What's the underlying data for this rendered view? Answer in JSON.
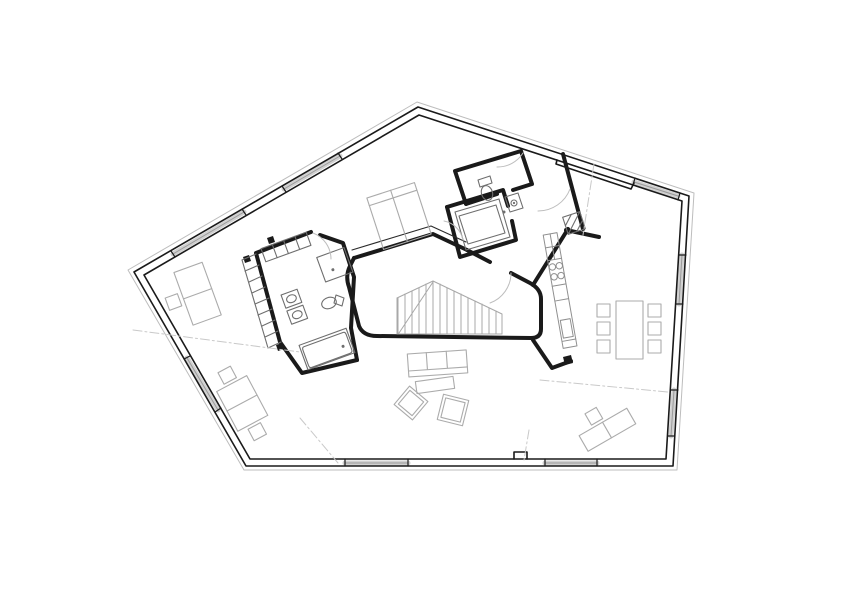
{
  "canvas": {
    "width": 842,
    "height": 595,
    "background": "#ffffff"
  },
  "palette": {
    "wall": "#1a1a1a",
    "wall_detail": "#2a2a2a",
    "fixture": "#6e6e6e",
    "counter": "#8f8f8f",
    "stair": "#a8a8a8",
    "furniture": "#ababab",
    "door": "#bdbdbd",
    "boundary": "#bdbdbd",
    "window_band": "#d0d0d0",
    "window_mid": "#9a9a9a",
    "dash": "#c9c9c9"
  },
  "layers": [
    {
      "name": "site-boundary-line",
      "stroke": "boundary",
      "width": 1,
      "shapes": [
        {
          "p": "M417,102 L694,193 L677,470 L244,470 L128,270 Z"
        }
      ]
    },
    {
      "name": "window-band",
      "stroke": "window_band",
      "width": 5,
      "shapes": [
        {
          "p": "M173,254 L244,212"
        },
        {
          "p": "M284,189 L340,156"
        },
        {
          "p": "M634,182 L678,196"
        },
        {
          "p": "M682,255 L679,304"
        },
        {
          "p": "M674,390 L671,436"
        },
        {
          "p": "M345,463 L408,463"
        },
        {
          "p": "M545,463 L597,463"
        },
        {
          "p": "M218,410 L187,358"
        }
      ]
    },
    {
      "name": "window-glass-line",
      "stroke": "window_mid",
      "width": 1,
      "shapes": [
        {
          "p": "M173,254 L244,212"
        },
        {
          "p": "M284,189 L340,156"
        },
        {
          "p": "M634,182 L678,196"
        },
        {
          "p": "M682,255 L679,304"
        },
        {
          "p": "M674,390 L671,436"
        },
        {
          "p": "M345,463 L408,463"
        },
        {
          "p": "M545,463 L597,463"
        },
        {
          "p": "M218,410 L187,358"
        }
      ]
    },
    {
      "name": "exterior-wall-outer-face",
      "stroke": "wall",
      "width": 1.6,
      "shapes": [
        {
          "p": "M418,107 L689,196 L673,466 L246,466 L134,272 Z"
        }
      ]
    },
    {
      "name": "exterior-wall-inner-face",
      "stroke": "wall",
      "width": 1.6,
      "shapes": [
        {
          "p": "M419,115 L682,201 L666,459 L250,459 L144,275 Z"
        },
        {
          "p": "M557,160 L556,164 L631,189 L634,183"
        },
        {
          "p": "M514,459 L514,452 L527,452 L527,459"
        }
      ]
    },
    {
      "name": "wall-opening-tick",
      "stroke": "wall",
      "width": 1.2,
      "shapes": [
        {
          "p": "M171,251 L175,257"
        },
        {
          "p": "M242,209 L246,215"
        },
        {
          "p": "M282,186 L286,192"
        },
        {
          "p": "M338,153 L342,159"
        },
        {
          "p": "M635,178 L633,185"
        },
        {
          "p": "M680,193 L678,200"
        },
        {
          "p": "M686,255 L679,255"
        },
        {
          "p": "M683,304 L676,304"
        },
        {
          "p": "M678,390 L671,390"
        },
        {
          "p": "M675,436 L668,436"
        },
        {
          "p": "M345,466 L345,459"
        },
        {
          "p": "M408,466 L408,459"
        },
        {
          "p": "M545,466 L545,459"
        },
        {
          "p": "M597,466 L597,459"
        },
        {
          "p": "M215,412 L221,408"
        },
        {
          "p": "M184,359 L190,356"
        }
      ]
    },
    {
      "name": "interior-wall",
      "stroke": "wall",
      "width": 4,
      "shapes": [
        {
          "p": "M354,258 L433,234 L467,250"
        },
        {
          "p": "M467,250 L490,262"
        },
        {
          "p": "M511,273 L530,283 Q541,289 541,299 L541,329 Q541,338 531,338"
        },
        {
          "p": "M531,338 L377,336 Q363,336 359,326 L349,287 Q345,276 350,266 L354,258"
        },
        {
          "p": "M533,340 L552,368 L571,361"
        },
        {
          "p": "M533,285 L568,229"
        },
        {
          "p": "M563,154 L583,229"
        },
        {
          "p": "M566,230 L599,237"
        },
        {
          "p": "M466,204 L455,171 L521,151 L532,184 L513,190"
        },
        {
          "p": "M497,194 L466,204"
        },
        {
          "p": "M447,207 L503,190 L508,206"
        },
        {
          "p": "M512,221 L516,240 L460,257 L447,207"
        },
        {
          "p": "M311,232 L256,253 L280,342 L302,373 L357,360"
        },
        {
          "p": "M357,360 L351,328 L354,277 L343,243 L320,235"
        }
      ]
    },
    {
      "name": "interior-wall-finish-line",
      "stroke": "wall_detail",
      "width": 1.1,
      "shapes": [
        {
          "p": "M352,250 L431,226 L466,242"
        }
      ]
    },
    {
      "name": "column",
      "stroke": "none",
      "fill": "wall",
      "width": 0,
      "shapes": [
        {
          "p": "M243,257 L249,255 L251,261 L245,263 Z"
        },
        {
          "p": "M267,238 L273,236 L275,242 L269,244 Z"
        },
        {
          "p": "M276,345 L282,343 L284,349 L278,351 Z"
        },
        {
          "p": "M563,357 L571,355 L573,363 L565,365 Z"
        }
      ]
    },
    {
      "name": "staircase",
      "stroke": "stair",
      "width": 1,
      "shapes": [
        {
          "p": "M397,298 L433,281 L502,314 L502,334"
        },
        {
          "p": "M397,298 L397,334"
        },
        {
          "p": "M397,334 L502,334"
        },
        {
          "p": "M398,298 L398,334 M405,294 L405,334 M412,291 L412,334 M419,288 L419,334 M426,284 L426,334 M433,281 L433,334 M440,284 L440,334 M447,288 L447,334 M454,291 L454,334 M461,294 L461,334 M468,298 L468,334 M475,301 L475,334 M482,304 L482,334 M489,308 L489,334 M496,311 L496,334"
        },
        {
          "p": "M433,282 L399,333"
        }
      ]
    },
    {
      "name": "kitchen-counter",
      "stroke": "counter",
      "width": 1,
      "shapes": [
        {
          "p": "M553,233 L567,233 L567,348 L553,348 Z",
          "tf": "rotate(-10 560 290)"
        },
        {
          "p": "M553,246 L567,246 M553,259 L567,259 M553,285 L567,285 M553,300 L567,300 M553,341 L567,341 M560,233 L560,259",
          "tf": "rotate(-10 560 290)"
        },
        {
          "p": "M555,320 L565,320 L565,338 L555,338 Z",
          "tf": "rotate(-10 560 290)"
        },
        {
          "c": [
            556.5,
            266,
            3.2
          ],
          "tf": "rotate(-10 560 290)"
        },
        {
          "c": [
            563.5,
            266,
            3.2
          ],
          "tf": "rotate(-10 560 290)"
        },
        {
          "c": [
            556.5,
            276,
            3.2
          ],
          "tf": "rotate(-10 560 290)"
        },
        {
          "c": [
            563.5,
            276,
            3.2
          ],
          "tf": "rotate(-10 560 290)"
        }
      ]
    },
    {
      "name": "bath-fixture",
      "stroke": "fixture",
      "width": 1.1,
      "shapes": [
        {
          "e": [
            487,
            193,
            5.5,
            7.5
          ],
          "tf": "rotate(-17 487 193)"
        },
        {
          "p": "M478,180 L490,176 L492,183 L480,187 Z"
        },
        {
          "p": "M505,197 L518,193 L523,208 L510,212 Z"
        },
        {
          "c": [
            514,
            203,
            3
          ]
        },
        {
          "p": "M455,212 L499,199 L510,237 L466,250 Z"
        },
        {
          "p": "M459,216 L496,205 L505,233 L468,244 Z"
        },
        {
          "p": "M286,291 L303,291 L303,305 L286,305 Z",
          "tf": "rotate(-20 295 307)"
        },
        {
          "p": "M286,308 L303,308 L303,322 L286,322 Z",
          "tf": "rotate(-20 295 307)"
        },
        {
          "e": [
            294.5,
            298,
            5,
            3.8
          ],
          "tf": "rotate(-20 295 307)"
        },
        {
          "e": [
            294.5,
            315,
            5,
            3.8
          ],
          "tf": "rotate(-20 295 307)"
        },
        {
          "e": [
            329,
            303,
            7.5,
            5.5
          ],
          "tf": "rotate(-20 329 303)"
        },
        {
          "p": "M336,295 L344,298 L342,306 L334,303 Z"
        },
        {
          "p": "M320,252 L349,252 L349,278 L320,278 Z",
          "tf": "rotate(-20 334 264)"
        },
        {
          "p": "M302,336 L352,336 L352,362 L302,362 Z",
          "tf": "rotate(-20 327 349)"
        },
        {
          "p": "M306,339 L348,339 Q350,339 350,342 L350,358 Q350,361 347,361 L306,361 Q304,361 304,358 L304,342 Q304,339 306,339 Z",
          "tf": "rotate(-20 327 349)"
        },
        {
          "p": "M565,214 L583,214 L583,232 L565,232 Z",
          "tf": "rotate(-18 574 223)"
        },
        {
          "p": "M565,232 L583,214 M565,223 L574,214 M574,232 L583,223",
          "tf": "rotate(-18 574 223)"
        },
        {
          "p": "M262,240 L310,240 L310,254 L262,254 Z",
          "tf": "rotate(-20 286 247)"
        },
        {
          "p": "M274,240 L274,254 M286,240 L286,254 M298,240 L298,254",
          "tf": "rotate(-20 286 247)"
        },
        {
          "p": "M242,260 L268,348"
        },
        {
          "p": "M242,260 L256,254 M245,271 L259,265 M249,282 L262,276 M252,293 L265,287 M255,304 L269,298 M258,315 L272,309 M262,326 L275,320 M265,337 L278,331 M268,348 L281,342"
        }
      ]
    },
    {
      "name": "fixture-drain-dot",
      "stroke": "none",
      "fill": "fixture",
      "width": 0,
      "shapes": [
        {
          "c": [
            504,
            212,
            1.5
          ]
        },
        {
          "c": [
            331,
            269,
            1.5
          ],
          "tf": "rotate(-20 334 264)"
        },
        {
          "c": [
            343,
            352,
            1.5
          ],
          "tf": "rotate(-20 327 349)"
        },
        {
          "c": [
            514,
            203,
            1.1
          ]
        }
      ]
    },
    {
      "name": "furniture",
      "stroke": "furniture",
      "width": 1.1,
      "shapes": [
        {
          "p": "M374,189 L424,189 L424,243 L374,243 Z",
          "tf": "rotate(-18 399 216)"
        },
        {
          "p": "M399,189 L399,243 M374,197 L424,197",
          "tf": "rotate(-18 399 216)"
        },
        {
          "p": "M616,301 L643,301 L643,359 L616,359 Z"
        },
        {
          "p": "M597,304 L610,304 L610,317 L597,317 Z"
        },
        {
          "p": "M597,322 L610,322 L610,335 L597,335 Z"
        },
        {
          "p": "M597,340 L610,340 L610,353 L597,353 Z"
        },
        {
          "p": "M648,304 L661,304 L661,317 L648,317 Z"
        },
        {
          "p": "M648,322 L661,322 L661,335 L648,335 Z"
        },
        {
          "p": "M648,340 L661,340 L661,353 L648,353 Z"
        },
        {
          "p": "M408,352 L467,352 L467,375 L408,375 Z",
          "tf": "rotate(-4 437 363)"
        },
        {
          "p": "M408,369 L467,369 M427,352 L427,369 M447,352 L447,369",
          "tf": "rotate(-4 437 363)"
        },
        {
          "p": "M416,379 L454,379 L454,391 L416,391 Z",
          "tf": "rotate(-8 435 385)"
        },
        {
          "p": "M399,391 L423,391 L423,415 L399,415 Z",
          "tf": "rotate(40 411 403)"
        },
        {
          "p": "M402,394 L420,394 L420,412 L402,412 Z",
          "tf": "rotate(40 411 403)"
        },
        {
          "p": "M440,397 L466,397 L466,423 L440,423 Z",
          "tf": "rotate(14 453 410)"
        },
        {
          "p": "M443,400 L463,400 L463,420 L443,420 Z",
          "tf": "rotate(14 453 410)"
        },
        {
          "p": "M183,266 L213,266 L213,322 L183,322 Z",
          "tf": "rotate(-20 197 295)"
        },
        {
          "p": "M183,294 L213,294",
          "tf": "rotate(-20 197 295)"
        },
        {
          "p": "M166,287 L179,287 L179,300 L166,300 Z",
          "tf": "rotate(-20 197 295)"
        },
        {
          "p": "M225,381 L259,381 L259,426 L225,426 Z",
          "tf": "rotate(-28 242 403)"
        },
        {
          "p": "M225,403 L259,403",
          "tf": "rotate(-28 242 403)"
        },
        {
          "p": "M235,365 L249,365 L249,378 L235,378 Z",
          "tf": "rotate(-28 242 403)"
        },
        {
          "p": "M235,429 L249,429 L249,442 L235,442 Z",
          "tf": "rotate(-28 242 403)"
        },
        {
          "p": "M580,421 L635,421 L635,439 L580,439 Z",
          "tf": "rotate(-30 607 430)"
        },
        {
          "p": "M607,421 L607,439",
          "tf": "rotate(-30 607 430)"
        },
        {
          "p": "M596,405 L609,405 L609,418 L596,418 Z",
          "tf": "rotate(-30 607 430)"
        }
      ]
    },
    {
      "name": "door-swing",
      "stroke": "door",
      "width": 1,
      "shapes": [
        {
          "p": "M511,273 A32,32 0 0 1 490,303"
        },
        {
          "p": "M313,233 A28,28 0 0 1 331,259"
        },
        {
          "p": "M523,153 A30,30 0 0 1 497,167"
        },
        {
          "p": "M570,189 A34,34 0 0 1 538,211"
        },
        {
          "p": "M444,221 A24,24 0 0 1 463,240"
        }
      ]
    },
    {
      "name": "section-dash-line",
      "stroke": "dash",
      "width": 1,
      "dash": "9 3 2 3",
      "shapes": [
        {
          "p": "M133,330 L300,352"
        },
        {
          "p": "M300,418 L338,463"
        },
        {
          "p": "M529,430 L524,460"
        },
        {
          "p": "M540,380 L668,392"
        },
        {
          "p": "M594,164 L583,235"
        }
      ]
    }
  ]
}
